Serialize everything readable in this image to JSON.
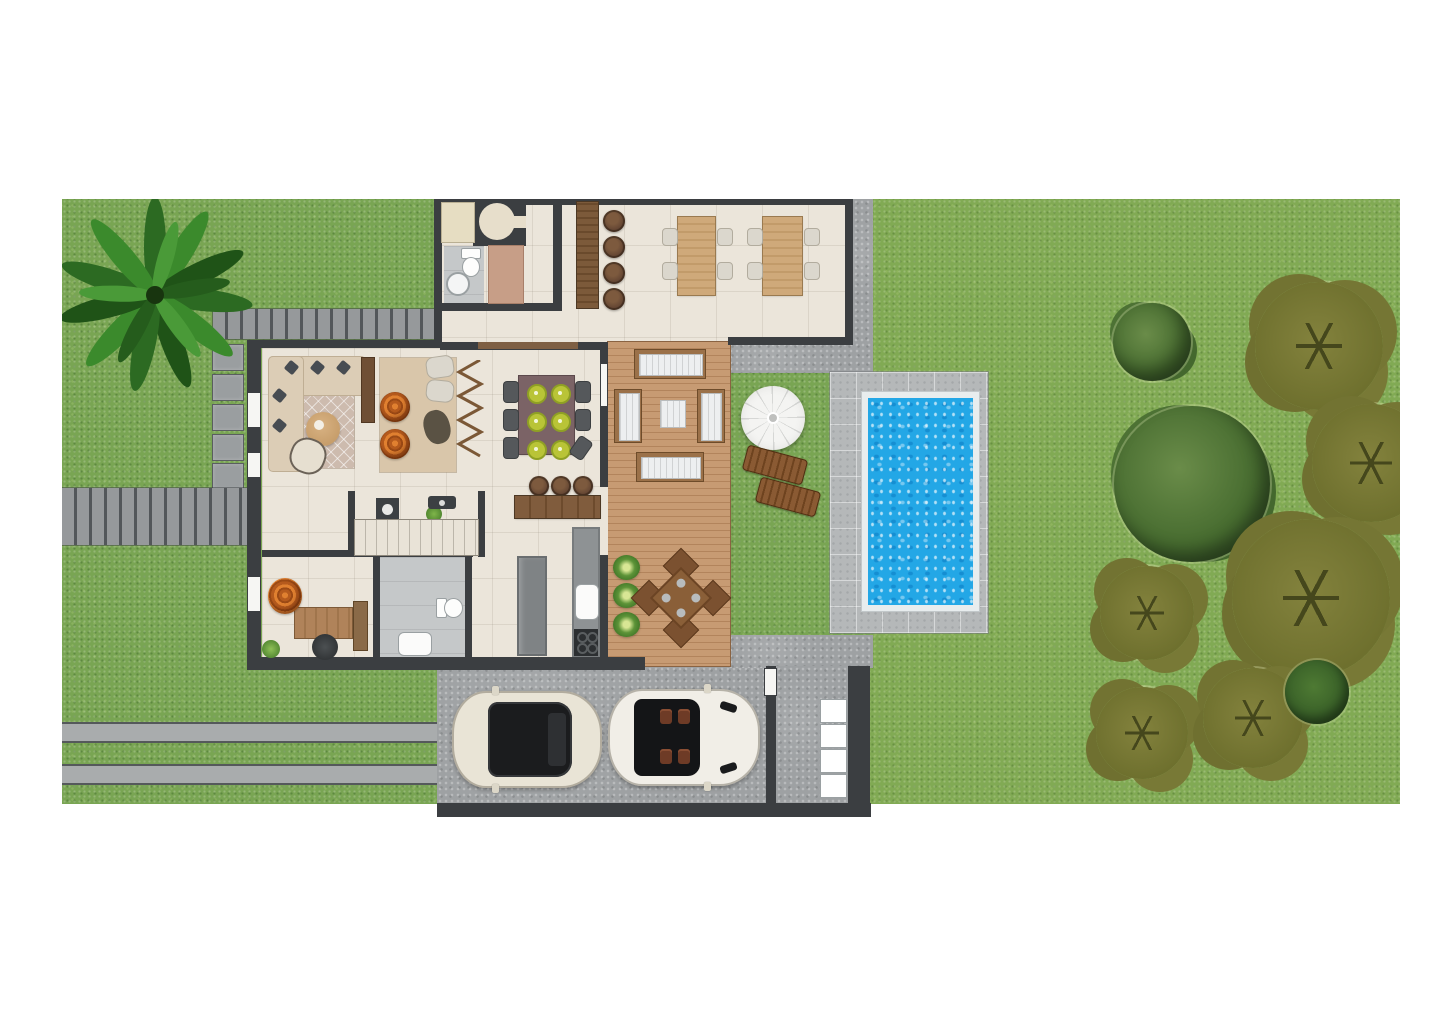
{
  "document": {
    "kind": "architectural site plan",
    "view": "top-down ground floor plan of a villa with garden, pool and driveway",
    "visible_text": "none"
  },
  "palette": {
    "background": "#ffffff",
    "grass": "#79a553",
    "walls": "#3b3e41",
    "interior_floor": "#ebe5da",
    "deck_wood": "#c79b73",
    "concrete": "#9ea1a3",
    "pool_deck_pavers": "#b5b8b9",
    "pool_water": "#23a7e6",
    "pool_coping": "#e8edee",
    "accent_orange_chairs": "#c9651f",
    "dark_wood": "#6a4a2c",
    "car_cream": "#e9e4d6",
    "car_white": "#f1eee7"
  },
  "garden": {
    "left_lawn": {
      "palm_trees": 1,
      "slatted_walkways": 2,
      "stepping_stones": 5,
      "road_strips": 2
    },
    "right_lawn": {
      "round_trees": 2,
      "olive_palm_trees": 6,
      "bushes": 1
    },
    "pool_lawn": {
      "parasol": 1,
      "sun_loungers": 2
    }
  },
  "pool": {
    "shape": "rectangle",
    "water_color": "#23a7e6",
    "coping": "white",
    "surround": "grey pavers"
  },
  "driveway": {
    "surface": "concrete",
    "vehicles": [
      {
        "type": "suv",
        "color": "cream",
        "roof": "black glass"
      },
      {
        "type": "convertible",
        "color": "white",
        "interior": "brown seats, open top"
      }
    ],
    "gate": "white side gate",
    "entry_steps": 4
  },
  "house": {
    "rooms": [
      {
        "name": "entry",
        "items": [
          "closet",
          "round table niche"
        ]
      },
      {
        "name": "powder-bathroom-top",
        "items": [
          "toilet",
          "round washbasin",
          "shower mat"
        ]
      },
      {
        "name": "great-room",
        "items": [
          "breakfast bar",
          "4 bar stools",
          "2 dining tables",
          "8 white chairs"
        ]
      },
      {
        "name": "living-room",
        "items": [
          "L-shaped sofa",
          "5 pillows",
          "lattice rug",
          "round coffee table",
          "armchair",
          "console",
          "2 orange papasan chairs",
          "2 cream chairs",
          "bean chair",
          "plain rug",
          "accordion glass door",
          "potted plant"
        ]
      },
      {
        "name": "dining-nook",
        "items": [
          "table with 6 green place settings",
          "6 chairs"
        ]
      },
      {
        "name": "kitchen",
        "items": [
          "island counter",
          "3 bar stools",
          "fridge",
          "sink",
          "gas hob"
        ]
      },
      {
        "name": "hallway",
        "items": [
          "staircase",
          "washing machine",
          "ceiling fan"
        ]
      },
      {
        "name": "office",
        "items": [
          "desk",
          "office chair",
          "orange lounge chair",
          "bookcase",
          "plant"
        ]
      },
      {
        "name": "bathroom-2",
        "items": [
          "washbasin",
          "toilet"
        ]
      },
      {
        "name": "deck",
        "items": [
          "2 cushioned benches",
          "2 cushioned sofas",
          "coffee table",
          "outdoor dining table",
          "4 outdoor chairs",
          "3 agave plants"
        ]
      }
    ]
  },
  "counts": {
    "cars": 2,
    "trees_total": 10,
    "dining_place_settings": 6,
    "bar_stools_total": 7
  }
}
